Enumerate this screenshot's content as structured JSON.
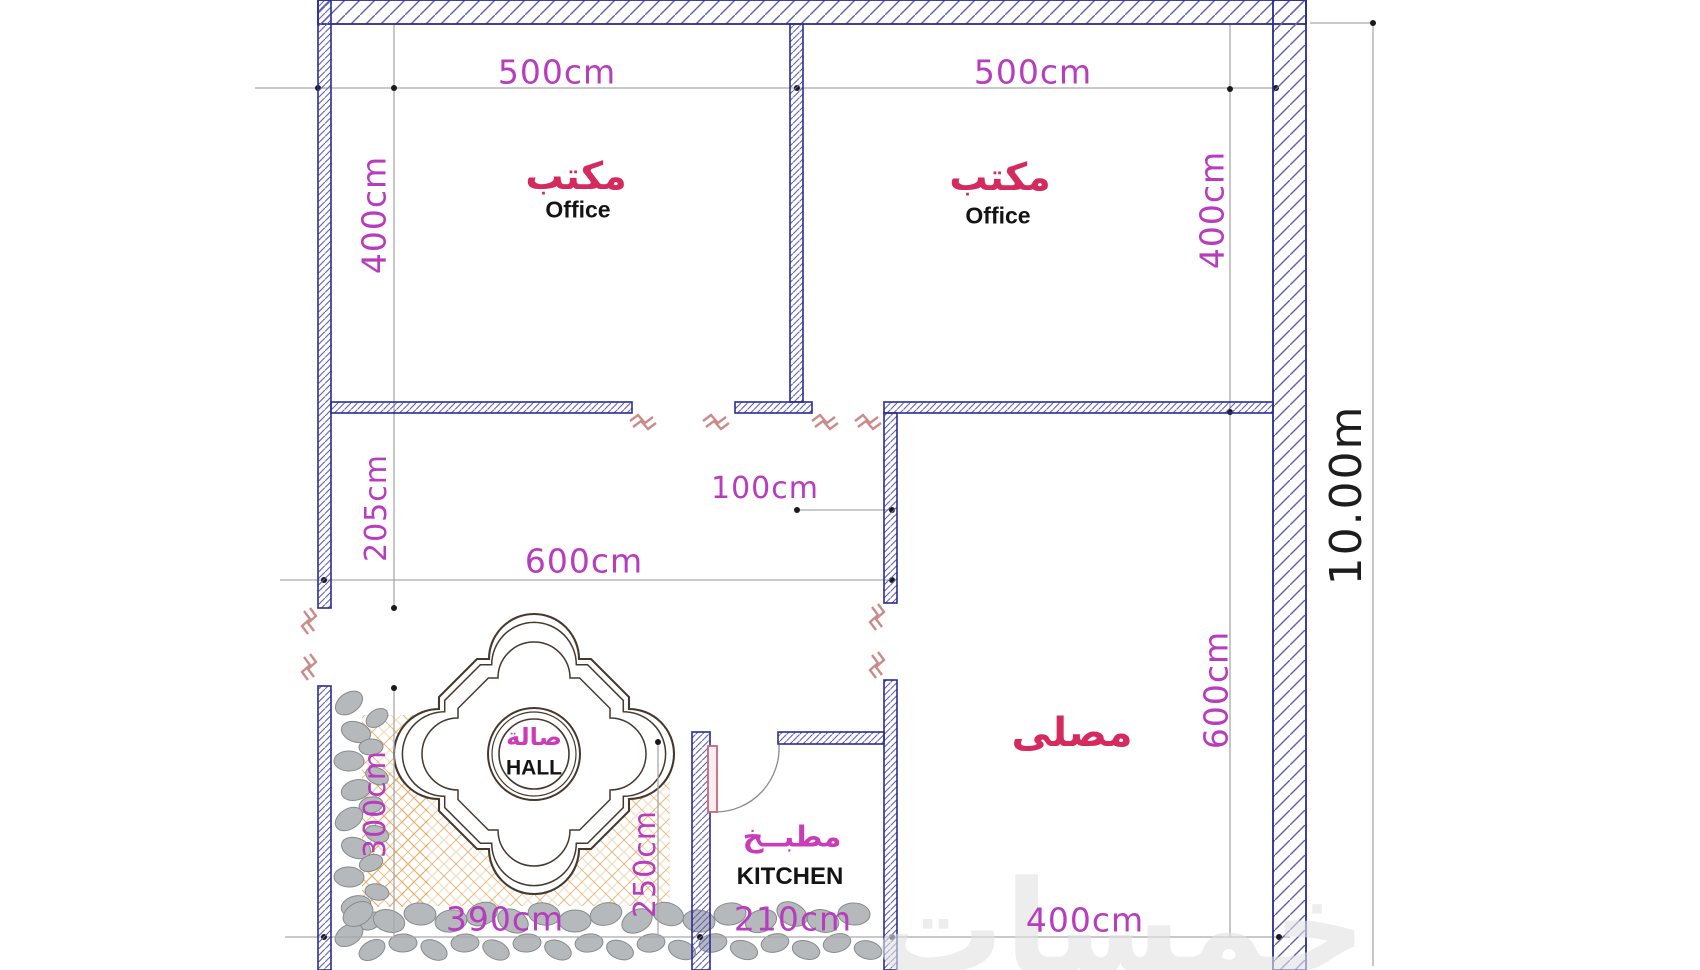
{
  "rooms": {
    "office_left": {
      "ar": "مكتب",
      "en": "Office"
    },
    "office_right": {
      "ar": "مكتب",
      "en": "Office"
    },
    "hall": {
      "ar": "صالة",
      "en": "HALL"
    },
    "kitchen": {
      "ar": "مطبــخ",
      "en": "KITCHEN"
    },
    "prayer": {
      "ar": "مصلى"
    }
  },
  "dims": {
    "office_left_width": "500cm",
    "office_right_width": "500cm",
    "office_left_height": "400cm",
    "office_right_height": "400cm",
    "hall_wall_upper": "205cm",
    "hall_width": "600cm",
    "passage_width": "100cm",
    "prayer_height": "600cm",
    "prayer_width": "400cm",
    "terrace_height": "300cm",
    "terrace_width": "390cm",
    "kitchen_side": "250cm",
    "kitchen_width": "210cm",
    "total_height": "10.00m"
  },
  "watermark": "خمسات",
  "colors": {
    "wall_outline": "#2c2c90",
    "wall_hatch": "#5f5fb8",
    "dim_text": "#b83cbe",
    "room_label": "#d42a5e",
    "break_marks": "#cc8b8b",
    "tile": "#e0a85f",
    "stone": "#b6b9bb",
    "medallion": "#46382e"
  }
}
